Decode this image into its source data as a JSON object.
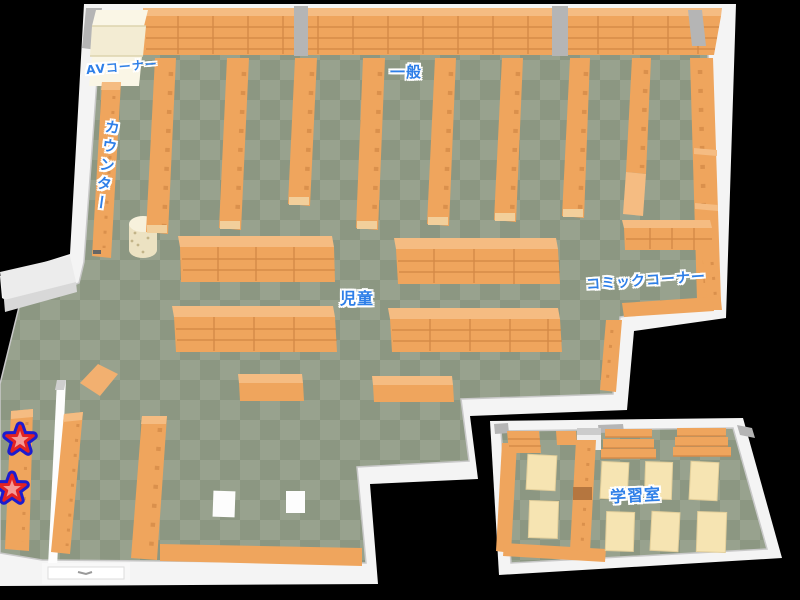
{
  "map": {
    "kind": "library-floor-map",
    "areas": {
      "av_corner": {
        "label": "AVコーナー"
      },
      "general": {
        "label": "一般"
      },
      "counter": {
        "label": "カウンター"
      },
      "children": {
        "label": "児童"
      },
      "comic_corner": {
        "label": "コミックコーナー"
      },
      "study_room": {
        "label": "学習室"
      }
    },
    "markers": [
      {
        "name": "star-marker-1",
        "type": "star"
      },
      {
        "name": "star-marker-2",
        "type": "star"
      }
    ]
  },
  "colors": {
    "floor_light": "#98a28e",
    "floor_dark": "#8c9782",
    "wall": "#f4f4f4",
    "wall_edge": "#c9c9c9",
    "gray_cap": "#b5b5b5",
    "shelf": "#efa55d",
    "shelf_top": "#f5bc82",
    "shelf_dark": "#d68c49",
    "shelf_grid": "#c9803f",
    "shelf_cap": "#f2cf9b",
    "cream": "#f3ecd3",
    "cream2": "#faf6e6",
    "desk": "#f6e4b2",
    "label_blue": "#2e7fe8",
    "star_fill": "#f59a94",
    "star_red": "#e32222",
    "star_blue": "#1c1ccf"
  }
}
